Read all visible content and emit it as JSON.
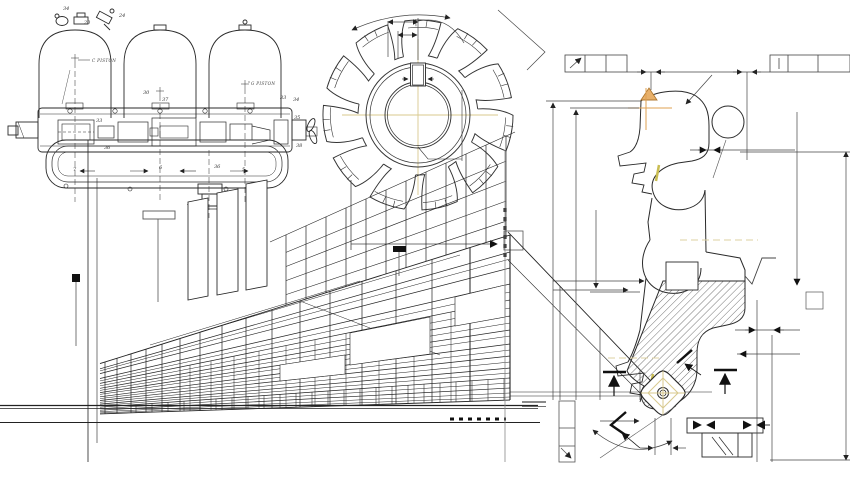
{
  "canvas": {
    "width": 850,
    "height": 480,
    "background": "#ffffff"
  },
  "palette": {
    "ink": "#222222",
    "mid_line": "#444444",
    "thin_line": "#777777",
    "accent_orange": "#dfa050",
    "centerline_yellow": "#d8c98e",
    "insert_yellow": "#c9bd52",
    "hatch_gray": "#666666",
    "marker_black": "#111111"
  },
  "patent_drawing": {
    "part_labels": [
      "34",
      "24",
      "20",
      "33",
      "34",
      "30",
      "37",
      "33",
      "36",
      "7",
      "6",
      "5",
      "35",
      "38",
      "37",
      "36"
    ],
    "caption_left": "C PISTON",
    "caption_right": "G PISTON"
  },
  "gear_cutter": {
    "tooth_count": 11
  },
  "building": {},
  "tool_section": {}
}
